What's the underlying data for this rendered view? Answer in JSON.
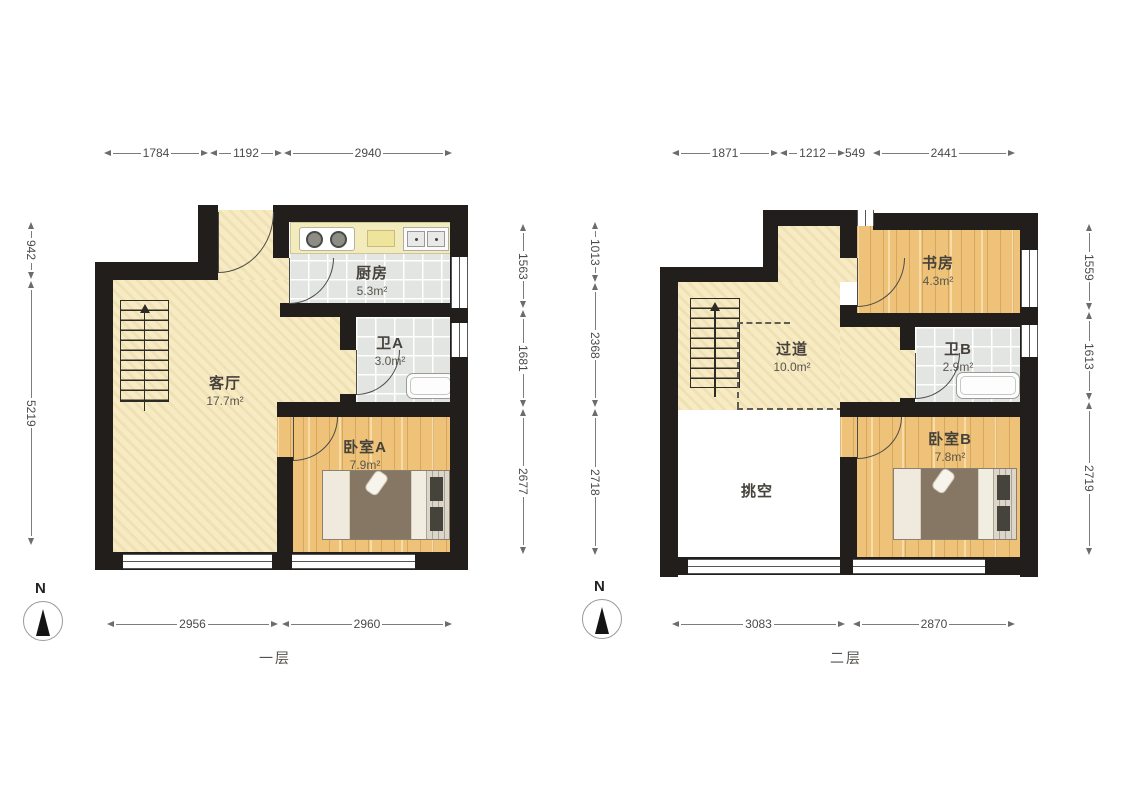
{
  "floors": [
    {
      "name": "一层",
      "compass": "N",
      "rooms": [
        {
          "label": "客厅",
          "area": "17.7m²"
        },
        {
          "label": "厨房",
          "area": "5.3m²"
        },
        {
          "label": "卫A",
          "area": "3.0m²"
        },
        {
          "label": "卧室A",
          "area": "7.9m²"
        }
      ],
      "dims": {
        "top": [
          "1784",
          "1192",
          "2940"
        ],
        "left": [
          "942",
          "5219"
        ],
        "right": [
          "1563",
          "1681",
          "2677"
        ],
        "bottom": [
          "2956",
          "2960"
        ]
      }
    },
    {
      "name": "二层",
      "compass": "N",
      "rooms": [
        {
          "label": "过道",
          "area": "10.0m²"
        },
        {
          "label": "书房",
          "area": "4.3m²"
        },
        {
          "label": "卫B",
          "area": "2.9m²"
        },
        {
          "label": "卧室B",
          "area": "7.8m²"
        },
        {
          "label": "挑空",
          "area": ""
        }
      ],
      "dims": {
        "top": [
          "1871",
          "1212",
          "549",
          "2441"
        ],
        "left": [
          "1013",
          "2368",
          "2718"
        ],
        "right": [
          "1559",
          "1613",
          "2719"
        ],
        "bottom": [
          "3083",
          "2870"
        ]
      }
    }
  ],
  "colors": {
    "wall": "#211e1b",
    "living": "#f7ebc3",
    "tile": "#e2e5e1",
    "wood": "#eec379"
  }
}
